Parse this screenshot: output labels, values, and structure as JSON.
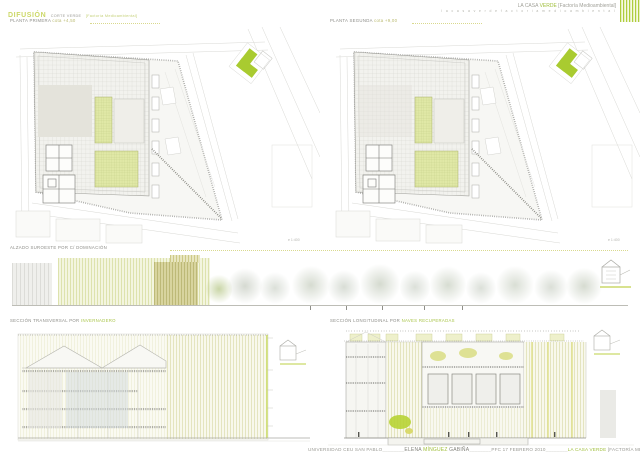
{
  "header": {
    "left": {
      "title": "DIFUSIÓN",
      "sub1": "CORTE VERDE",
      "sub2": "[Factoría Medioambiental]"
    },
    "right": {
      "t1": "LA CASA ",
      "t2": "VERDE",
      "t3": " [Factoría Medioambiental]",
      "line2": "l a  c a s a  v e r d e  f a c t o r í a  m e d i o a m b i e n t a l"
    }
  },
  "plans": {
    "left_label": "PLANTA PRIMERA",
    "left_note": "cota +4,50",
    "right_label": "PLANTA SEGUNDA",
    "right_note": "cota +9,00",
    "scale": "e 1:400"
  },
  "elevation": {
    "label": "ALZADO SUROESTE POR C/ DOMINACIÓN"
  },
  "sections": {
    "left_label": "SECCIÓN TRANSVERSAL POR",
    "left_note": "INVERNADERO",
    "right_label": "SECCIÓN LONGITUDINAL POR",
    "right_note": "NAVES RECUPERADAS"
  },
  "footer": {
    "university": "UNIVERSIDAD CEU SAN PABLO",
    "author_first": "ELENA ",
    "author_mid": "MÍNGUEZ",
    "author_last": " GABIÑA",
    "date": "PFC 17 FEBRERO 2010",
    "title_green": "LA CASA VERDE",
    "title_gray": " [FACTORÍA MEDIOAMBIENTAL]",
    "rule": "________"
  },
  "colors": {
    "accent_green": "#a9cb30",
    "pale_green_room": "#e0e8a6",
    "stripe_yellow": "#dde2ad",
    "olive": "#bdb977",
    "line_gray": "#c9c9c3",
    "text_gray": "#8d8d88"
  }
}
